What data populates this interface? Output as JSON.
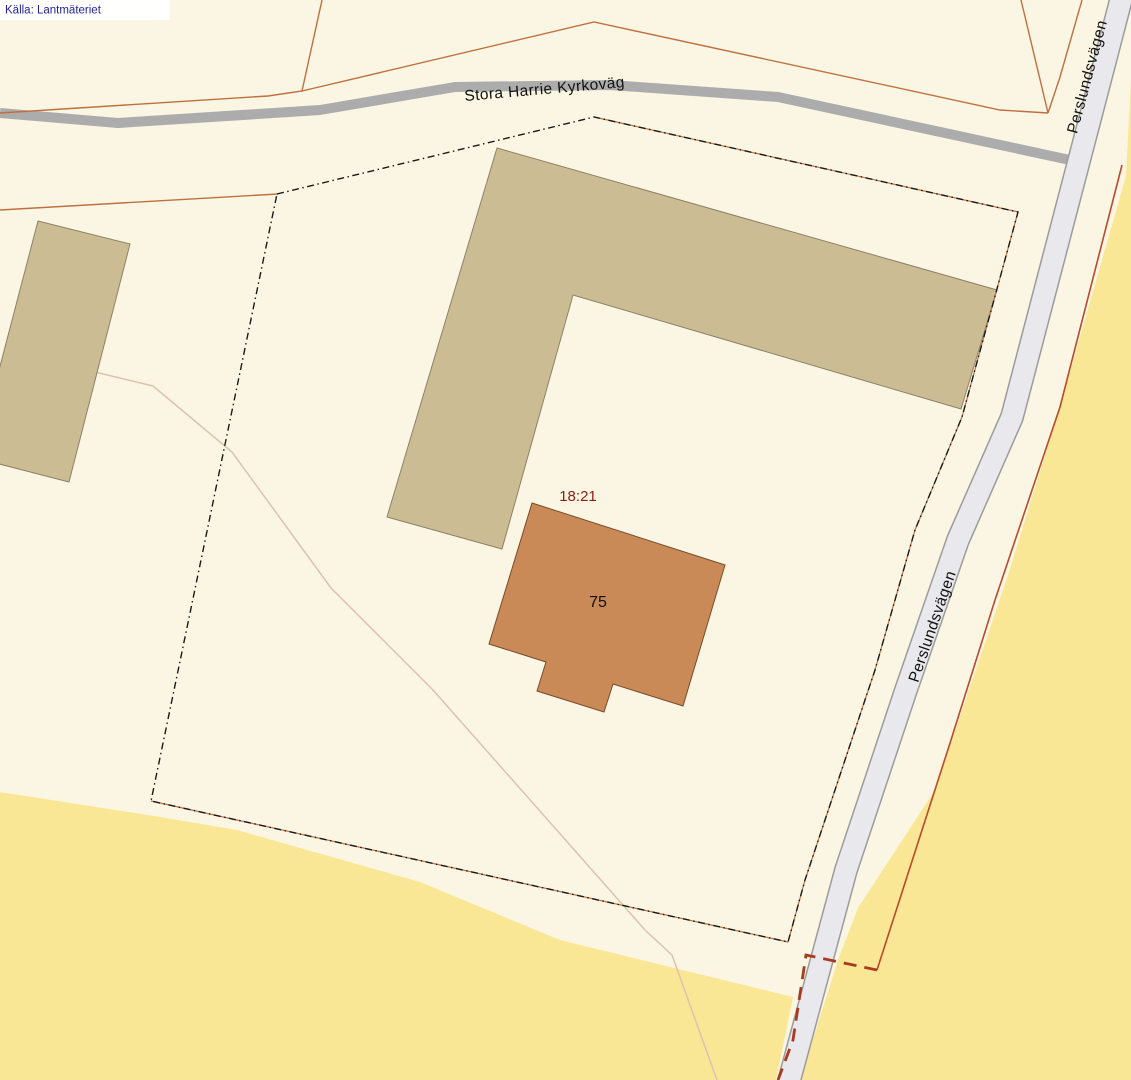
{
  "attribution": {
    "text": "Källa: Lantmäteriet"
  },
  "labels": {
    "road_main": "Stora Harrie Kyrkoväg",
    "road_side": "Perslundsvägen",
    "parcel_id": "18:21",
    "building_number": "75"
  },
  "colors": {
    "background_cream": "#faf6e3",
    "field_yellow": "#f9e795",
    "building_tan": "#cbbc93",
    "building_tan_border": "#8d8265",
    "building_orange": "#ca8a58",
    "building_orange_border": "#7a4a28",
    "road_gray": "#acacac",
    "side_road_fill": "#e9e9ed",
    "side_road_border": "#9b9b9b",
    "cadastral_brown": "#bf7040",
    "boundary_red_solid": "#bb4a2a",
    "boundary_maroon_dashed": "#a63b20",
    "parcel_dash_black": "#1a1a1a",
    "parcel_id_red": "#8b1d15",
    "path_faint": "#dcc3ae",
    "attribution_blue": "#2323a0"
  }
}
